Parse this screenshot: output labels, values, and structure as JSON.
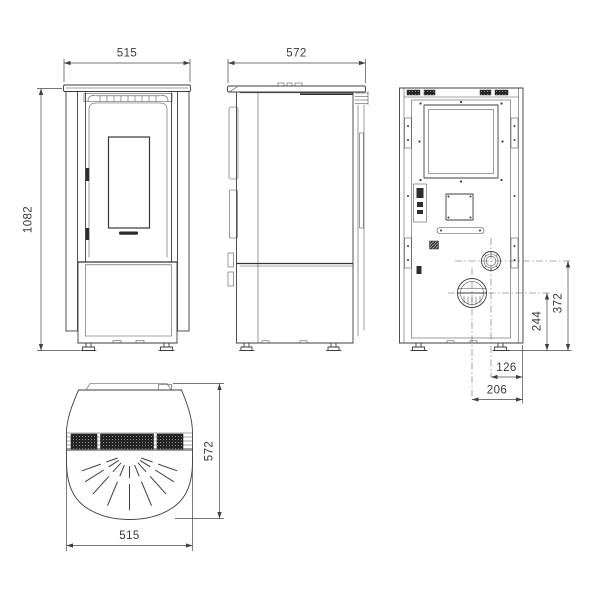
{
  "drawing": {
    "kind": "stove-technical-drawing",
    "background": "#ffffff",
    "line_color": "#3d3d3d",
    "dims": {
      "front_width": "515",
      "front_height": "1082",
      "side_depth": "572",
      "rear_flue_height": "372",
      "rear_air_height": "244",
      "rear_flue_offset": "126",
      "rear_air_offset": "206",
      "top_depth": "572",
      "top_width": "515"
    }
  }
}
